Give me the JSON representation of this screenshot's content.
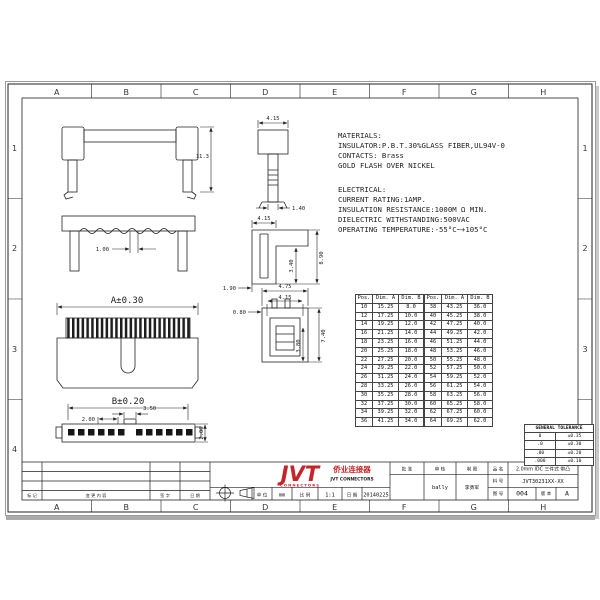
{
  "grid": {
    "columns": [
      "A",
      "B",
      "C",
      "D",
      "E",
      "F",
      "G",
      "H"
    ],
    "rows": [
      "1",
      "2",
      "3",
      "4"
    ]
  },
  "notes": {
    "materials": {
      "title": "MATERIALS:",
      "lines": [
        "INSULATOR:P.B.T.30%GLASS FIBER,UL94V-0",
        "CONTACTS: Brass",
        "GOLD FLASH OVER NICKEL"
      ]
    },
    "electrical": {
      "title": "ELECTRICAL:",
      "lines": [
        "CURRENT RATING:1AMP.",
        "INSULATION RESISTANCE:1000M Ω MIN.",
        "DIELECTRIC WITHSTANDING:500VAC",
        "OPERATING TEMPERATURE:-55°C~+105°C"
      ]
    }
  },
  "dims": {
    "front_height": "11.3",
    "cover_slot": "1.00",
    "dim_a": "A±0.30",
    "dim_b": "B±0.20",
    "pitch": "2.00",
    "key_width": "3.50",
    "side_height": "2.00",
    "sec1_width": "4.15",
    "sec1_tip": "1.40",
    "sec2_width": "4.15",
    "sec2_height": "8.90",
    "sec2_depth": "3.40",
    "sec2_foot": "1.90",
    "sec3_width_outer": "4.75",
    "sec3_width_inner": "4.15",
    "sec3_wall": "0.80",
    "sec3_height": "7.40",
    "sec3_depth": "3.80"
  },
  "tables": {
    "headers": [
      "Pos.",
      "Dim. A",
      "Dim. B"
    ],
    "left_rows": [
      [
        "10",
        "15.25",
        "8.0"
      ],
      [
        "12",
        "17.25",
        "10.0"
      ],
      [
        "14",
        "19.25",
        "12.0"
      ],
      [
        "16",
        "21.25",
        "14.0"
      ],
      [
        "18",
        "23.25",
        "16.0"
      ],
      [
        "20",
        "25.25",
        "18.0"
      ],
      [
        "22",
        "27.25",
        "20.0"
      ],
      [
        "24",
        "29.25",
        "22.0"
      ],
      [
        "26",
        "31.25",
        "24.0"
      ],
      [
        "28",
        "33.25",
        "26.0"
      ],
      [
        "30",
        "35.25",
        "28.0"
      ],
      [
        "32",
        "37.25",
        "30.0"
      ],
      [
        "34",
        "39.25",
        "32.0"
      ],
      [
        "36",
        "41.25",
        "34.0"
      ]
    ],
    "right_rows": [
      [
        "38",
        "43.25",
        "36.0"
      ],
      [
        "40",
        "45.25",
        "38.0"
      ],
      [
        "42",
        "47.25",
        "40.0"
      ],
      [
        "44",
        "49.25",
        "42.0"
      ],
      [
        "46",
        "51.25",
        "44.0"
      ],
      [
        "48",
        "53.25",
        "46.0"
      ],
      [
        "50",
        "55.25",
        "48.0"
      ],
      [
        "52",
        "57.25",
        "50.0"
      ],
      [
        "54",
        "59.25",
        "52.0"
      ],
      [
        "56",
        "61.25",
        "54.0"
      ],
      [
        "58",
        "63.25",
        "56.0"
      ],
      [
        "60",
        "65.25",
        "58.0"
      ],
      [
        "62",
        "67.25",
        "60.0"
      ],
      [
        "64",
        "69.25",
        "62.0"
      ]
    ]
  },
  "tolerance": {
    "title": "GENERAL TOLERANCE",
    "rows": [
      [
        "0",
        "±0.35"
      ],
      [
        ".0",
        "±0.30"
      ],
      [
        ".00",
        "±0.20"
      ],
      [
        ".000",
        "±0.10"
      ]
    ]
  },
  "title_block": {
    "logo_text": "JVT",
    "logo_sub": "CONNECTORS",
    "company_cn": "侨业连接器",
    "company_en": "JVT CONNECTORS",
    "unit_label": "单 位",
    "unit_value": "mm",
    "scale_label": "比 例",
    "scale_value": "1:1",
    "date_label": "日 期",
    "date_value": "20140225",
    "approve_label": "批 准",
    "audit_label": "审 核",
    "audit_value": "bally",
    "draw_label": "制 图",
    "draw_value": "李勇军",
    "product_label": "品 名",
    "product_value": "2.0mm IDC 三件式 带凸",
    "part_label": "料 号",
    "part_value": "JVT30231XX-XX",
    "drawing_no_label": "图 号",
    "drawing_no_value": "004",
    "rev_label": "版 本",
    "rev_value": "A"
  },
  "revision": {
    "labels": [
      "标 记",
      "变 更 内 容",
      "签 字",
      "日 期"
    ]
  }
}
